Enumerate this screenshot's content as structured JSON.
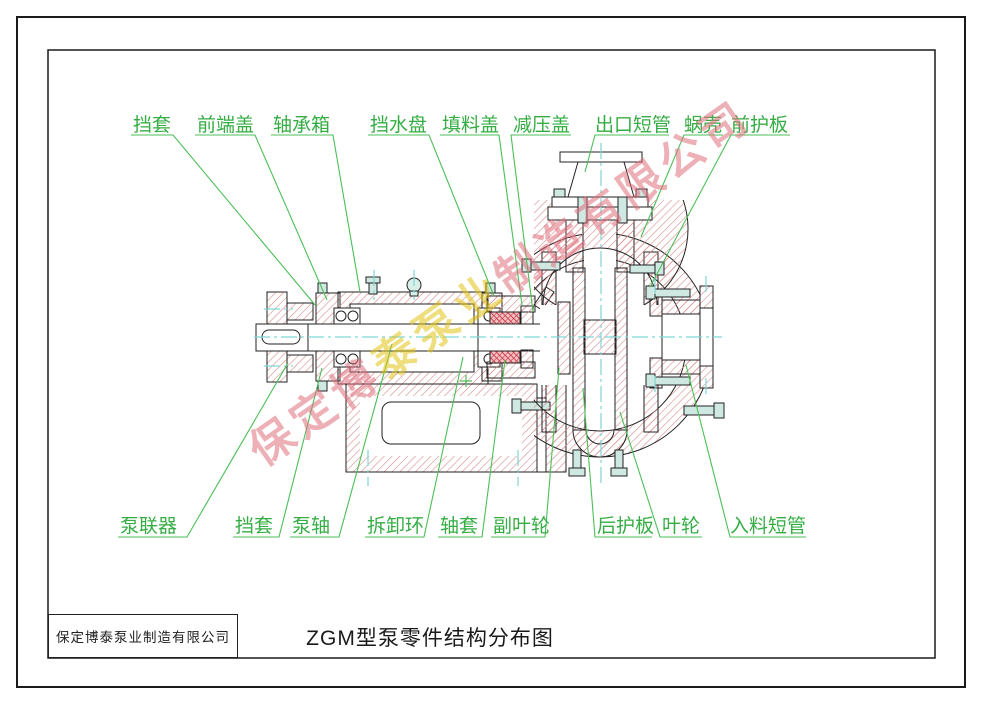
{
  "title_block": {
    "company": "保定博泰泵业制造有限公司",
    "drawing_title": "ZGM型泵零件结构分布图"
  },
  "watermark": {
    "text": "保定博泰泵业制造有限公司",
    "pink_color": "#e0707e",
    "yellow_color": "#e2c414",
    "yellow_char_indices": [
      3,
      4,
      5
    ]
  },
  "colors": {
    "hatch": "#d98b8b",
    "outline": "#222222",
    "centerline": "#7fd6d6",
    "leader_green": "#4bbf57",
    "packing_red": "#cc4455",
    "bolt_fill": "#cfe8e2"
  },
  "labels": {
    "top": [
      {
        "text": "挡套"
      },
      {
        "text": "前端盖"
      },
      {
        "text": "轴承箱"
      },
      {
        "text": "挡水盘"
      },
      {
        "text": "填料盖"
      },
      {
        "text": "减压盖"
      },
      {
        "text": "出口短管"
      },
      {
        "text": "蜗壳"
      },
      {
        "text": "前护板"
      }
    ],
    "bottom": [
      {
        "text": "泵联器"
      },
      {
        "text": "挡套"
      },
      {
        "text": "泵轴"
      },
      {
        "text": "拆卸环"
      },
      {
        "text": "轴套"
      },
      {
        "text": "副叶轮"
      },
      {
        "text": "后护板"
      },
      {
        "text": "叶轮"
      },
      {
        "text": "入料短管"
      }
    ]
  }
}
